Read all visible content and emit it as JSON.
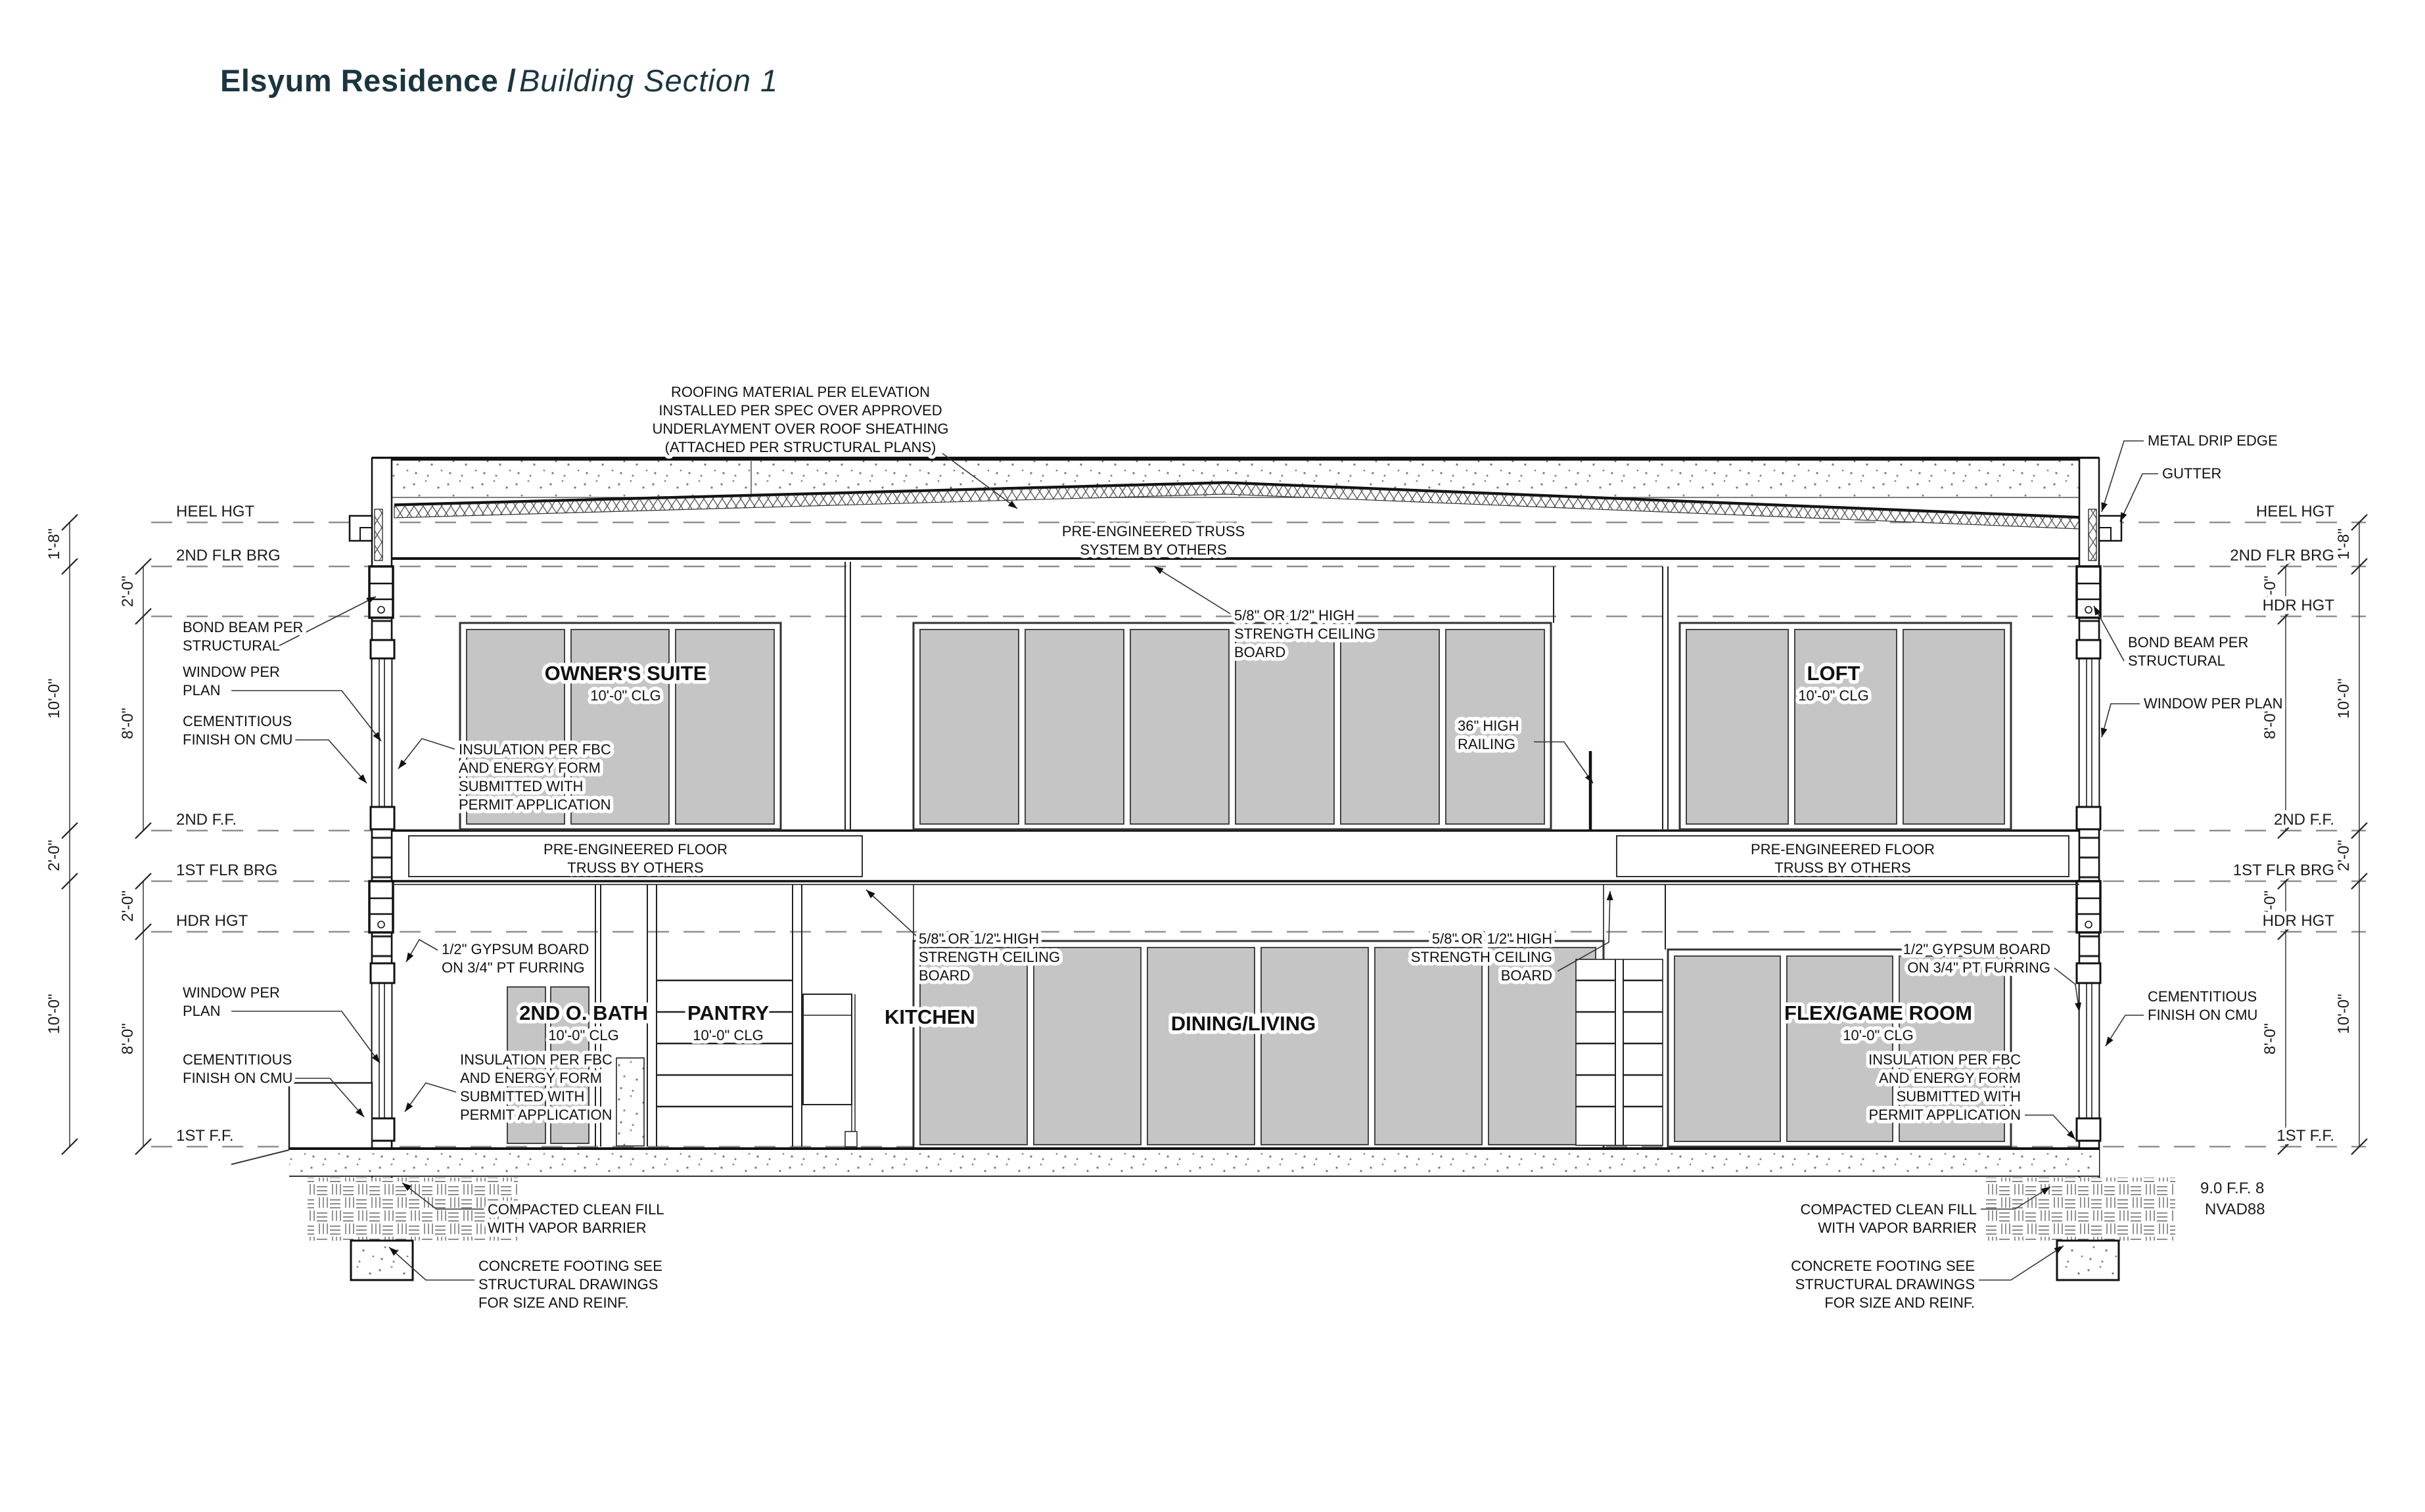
{
  "title": {
    "project": "Elsyum Residence /",
    "sheet": "Building Section 1"
  },
  "levels": {
    "heel": "HEEL HGT",
    "brg2": "2ND FLR BRG",
    "hdr": "HDR HGT",
    "ff2": "2ND F.F.",
    "brg1": "1ST FLR BRG",
    "ff1": "1ST F.F.",
    "datum1": "9.0 F.F. 8",
    "datum2": "NVAD88"
  },
  "dims": {
    "d18": "1'-8\"",
    "d20": "2'-0\"",
    "d80": "8'-0\"",
    "d100": "10'-0\""
  },
  "rooms": {
    "owners": {
      "name": "OWNER'S SUITE",
      "clg": "10'-0\" CLG"
    },
    "loft": {
      "name": "LOFT",
      "clg": "10'-0\" CLG"
    },
    "bath": {
      "name": "2ND O. BATH",
      "clg": "10'-0\" CLG"
    },
    "pantry": {
      "name": "PANTRY",
      "clg": "10'-0\" CLG"
    },
    "kitchen": {
      "name": "KITCHEN"
    },
    "dining": {
      "name": "DINING/LIVING"
    },
    "flex": {
      "name": "FLEX/GAME ROOM",
      "clg": "10'-0\" CLG"
    }
  },
  "notes": {
    "roofing": {
      "l1": "ROOFING MATERIAL PER ELEVATION",
      "l2": "INSTALLED PER SPEC OVER APPROVED",
      "l3": "UNDERLAYMENT OVER ROOF SHEATHING",
      "l4": "(ATTACHED PER STRUCTURAL PLANS)"
    },
    "truss_system": {
      "l1": "PRE-ENGINEERED TRUSS",
      "l2": "SYSTEM BY OTHERS"
    },
    "ceiling_board": {
      "l1": "5/8\" OR 1/2\" HIGH",
      "l2": "STRENGTH CEILING",
      "l3": "BOARD"
    },
    "floor_truss": {
      "l1": "PRE-ENGINEERED FLOOR",
      "l2": "TRUSS BY OTHERS"
    },
    "metal_drip_edge": "METAL DRIP EDGE",
    "gutter": "GUTTER",
    "bond_beam": {
      "l1": "BOND BEAM PER",
      "l2": "STRUCTURAL"
    },
    "window_plan2": {
      "l1": "WINDOW  PER",
      "l2": "PLAN"
    },
    "window_plan1": "WINDOW PER PLAN",
    "cementitious": {
      "l1": "CEMENTITIOUS",
      "l2": "FINISH ON CMU"
    },
    "insulation": {
      "l1": "INSULATION PER FBC",
      "l2": "AND ENERGY FORM",
      "l3": "SUBMITTED WITH",
      "l4": "PERMIT APPLICATION"
    },
    "gypsum": {
      "l1": "1/2\" GYPSUM BOARD",
      "l2": "ON 3/4\" PT FURRING"
    },
    "railing": {
      "l1": "36\" HIGH",
      "l2": "RAILING"
    },
    "compacted": {
      "l1": "COMPACTED CLEAN FILL",
      "l2": "WITH VAPOR BARRIER"
    },
    "footing": {
      "l1": "CONCRETE FOOTING SEE",
      "l2": "STRUCTURAL DRAWINGS",
      "l3": "FOR SIZE AND REINF."
    }
  }
}
